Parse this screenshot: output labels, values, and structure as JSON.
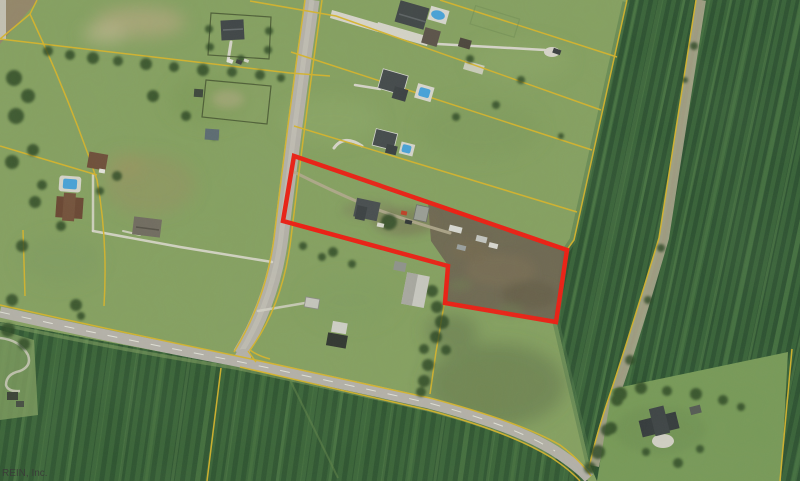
{
  "map": {
    "description": "Aerial real-estate parcel photo with outlined lot",
    "watermark": "REIN, Inc.",
    "highlighted_parcel": {
      "outline_color": "#ee1d12",
      "outline_width": "4.5",
      "points": "294,156 567,250 556,322 445,303 448,266 283,221"
    },
    "colors": {
      "parcel_line_yellow": "#d9b52b",
      "road_gray": "#b6b2aa",
      "crop_field_green": "#2d5130",
      "lawn_green": "#86a161",
      "plowed_dirt_brown": "#6e6351",
      "pool_blue": "#47a2da"
    }
  }
}
